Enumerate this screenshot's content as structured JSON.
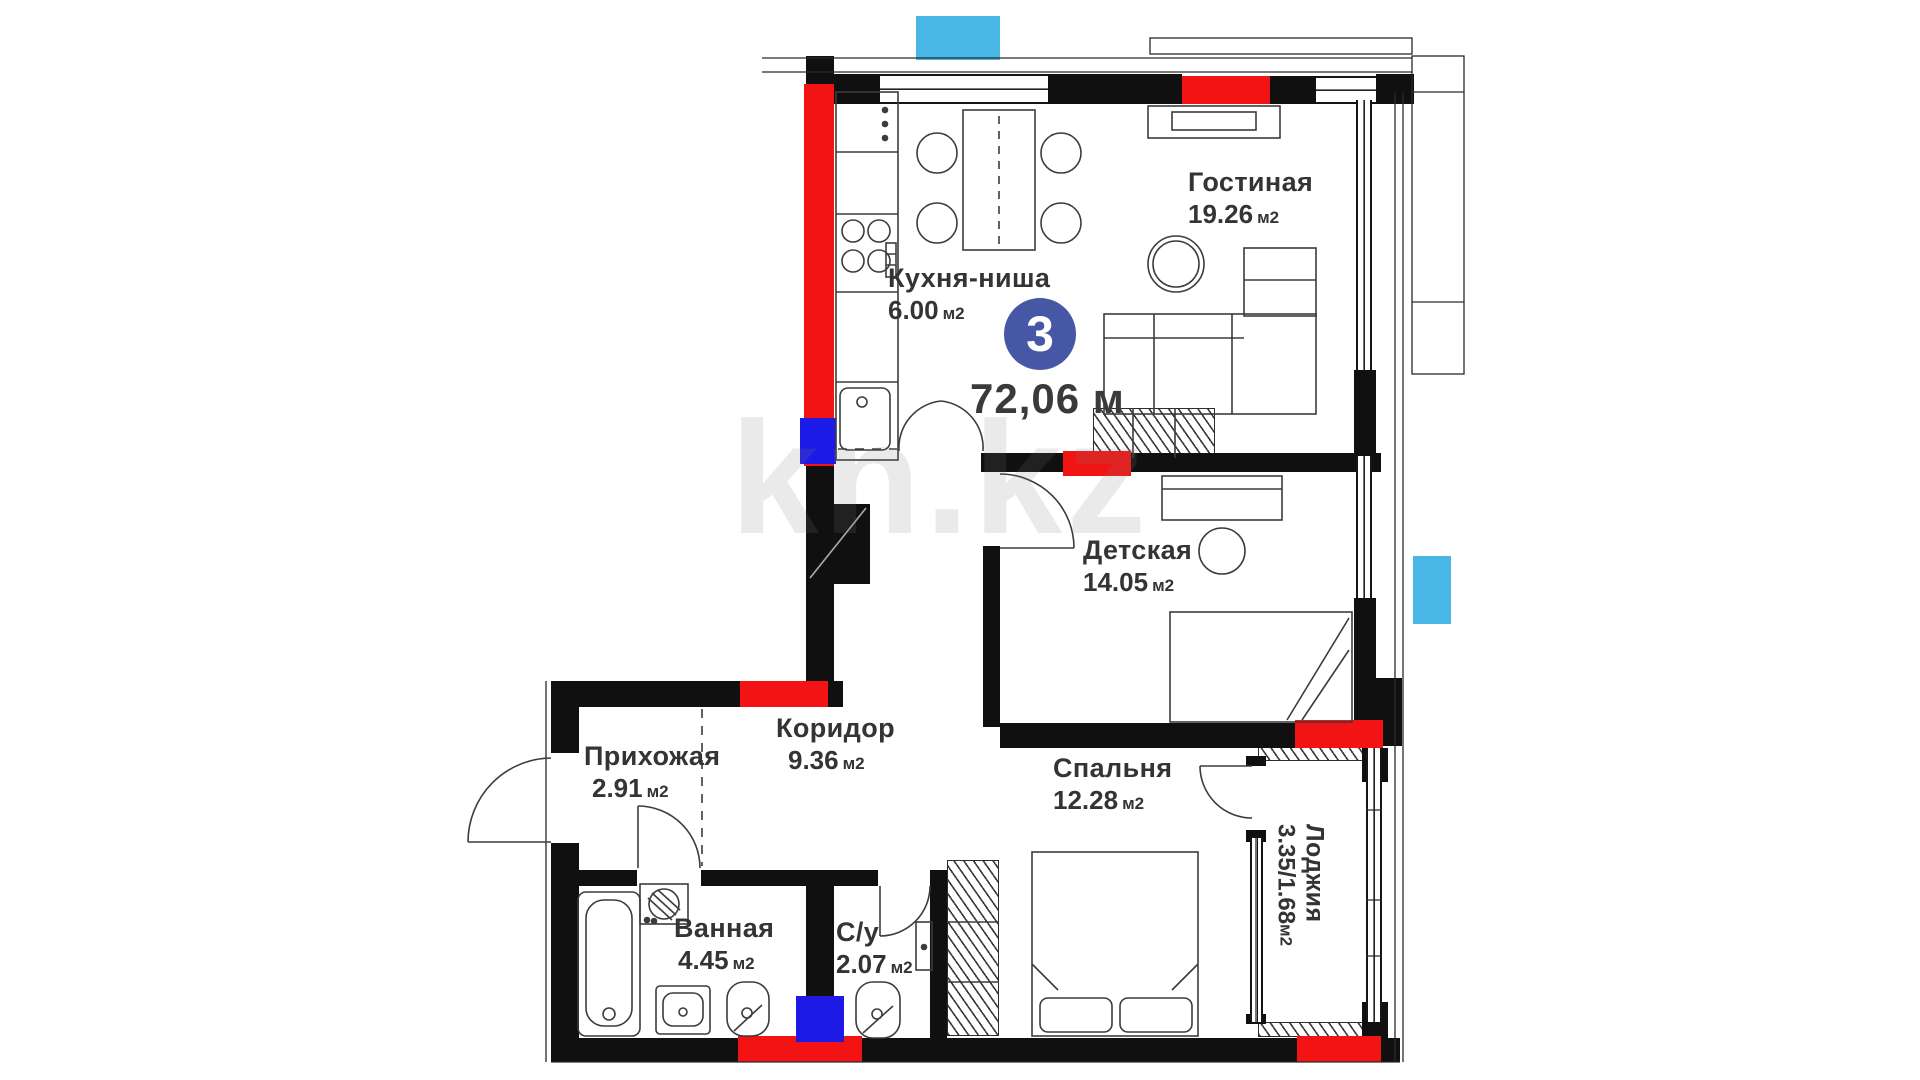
{
  "plan": {
    "title": "floor-plan",
    "number_badge": "3",
    "total_area": "72,06 м",
    "watermark": "kn.kz",
    "colors": {
      "wall": "#101010",
      "accent_red": "#f21414",
      "accent_blue": "#1d1ae6",
      "marker_cyan": "#49b7e6",
      "badge_blue": "#4657a6"
    },
    "rooms": [
      {
        "id": "kitchen",
        "name": "Кухня-ниша",
        "area": "6.00",
        "unit": "м2"
      },
      {
        "id": "living",
        "name": "Гостиная",
        "area": "19.26",
        "unit": "м2"
      },
      {
        "id": "children",
        "name": "Детская",
        "area": "14.05",
        "unit": "м2"
      },
      {
        "id": "corridor",
        "name": "Коридор",
        "area": "9.36",
        "unit": "м2"
      },
      {
        "id": "hallway",
        "name": "Прихожая",
        "area": "2.91",
        "unit": "м2"
      },
      {
        "id": "bedroom",
        "name": "Спальня",
        "area": "12.28",
        "unit": "м2"
      },
      {
        "id": "bathroom",
        "name": "Ванная",
        "area": "4.45",
        "unit": "м2"
      },
      {
        "id": "wc",
        "name": "С/у",
        "area": "2.07",
        "unit": "м2"
      },
      {
        "id": "loggia",
        "name": "Лоджия",
        "area": "3.35/1.68",
        "unit": "м2"
      }
    ]
  }
}
